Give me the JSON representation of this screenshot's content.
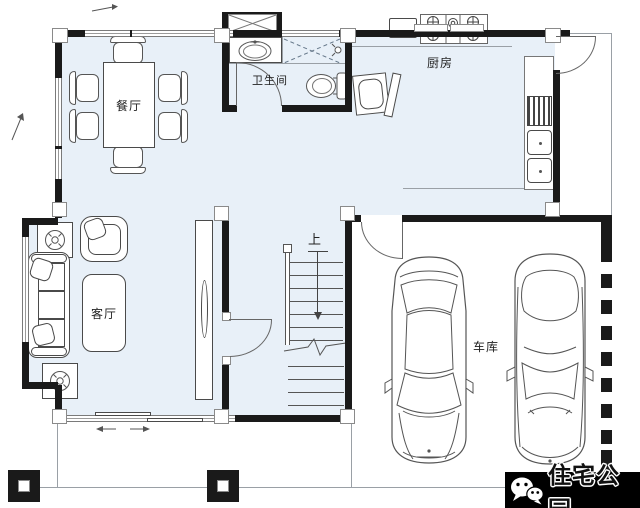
{
  "rooms": {
    "dining": {
      "label": "餐厅"
    },
    "bathroom": {
      "label": "卫生间"
    },
    "kitchen": {
      "label": "厨房"
    },
    "living": {
      "label": "客厅"
    },
    "garage": {
      "label": "车库"
    }
  },
  "stairs": {
    "direction_label": "上"
  },
  "watermark": {
    "brand": "住宅公园",
    "icon": "wechat-icon"
  },
  "colors": {
    "floor_fill": "#e8f0f8",
    "wall": "#1a1a1a",
    "watermark_bg": "#000000",
    "line": "#555555"
  }
}
